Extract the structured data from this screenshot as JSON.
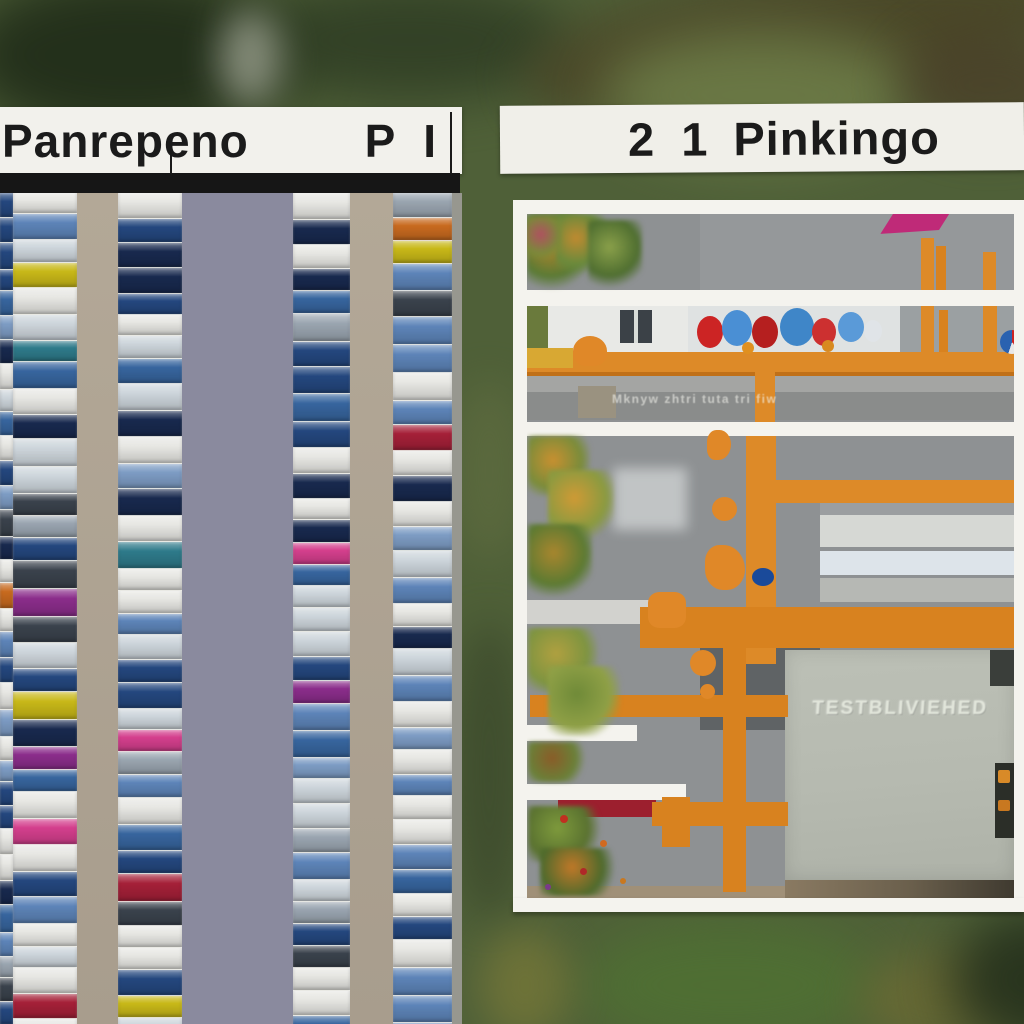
{
  "header": {
    "left_label": {
      "text": "Panrepeno",
      "code": "P I"
    },
    "right_label": {
      "number": "2 1",
      "text": "Pinkingo"
    }
  },
  "right_panel": {
    "building_text": "TESTBLIVIEHED",
    "road_text": "Mknyw zhtri tuta tri fiw",
    "frame_color": "#f4f3ee",
    "content_bg": "#8e9193",
    "rects": [
      {
        "n": "site-pavement",
        "x": 527,
        "y": 214,
        "w": 487,
        "h": 684,
        "c": "#8e9193"
      },
      {
        "n": "row1-pavement-shade",
        "x": 700,
        "y": 214,
        "w": 314,
        "h": 76,
        "c": "#95989a"
      },
      {
        "n": "row2-green-patch",
        "x": 527,
        "y": 306,
        "w": 22,
        "h": 46,
        "c": "#6a7a3c"
      },
      {
        "n": "row2-building-wall",
        "x": 548,
        "y": 306,
        "w": 142,
        "h": 46,
        "c": "#e8e9e6"
      },
      {
        "n": "row2-window",
        "x": 620,
        "y": 310,
        "w": 32,
        "h": 33,
        "c": "#3b4147"
      },
      {
        "n": "row2-window-slat",
        "x": 634,
        "y": 310,
        "w": 4,
        "h": 33,
        "c": "#d8dcd8"
      },
      {
        "n": "row2-white-backdrop",
        "x": 688,
        "y": 306,
        "w": 212,
        "h": 47,
        "c": "#dfe2e2"
      },
      {
        "n": "row2-gray-backdrop",
        "x": 900,
        "y": 306,
        "w": 114,
        "h": 47,
        "c": "#9ba0a2"
      },
      {
        "n": "row2-dot-markings",
        "x": 902,
        "y": 392,
        "w": 110,
        "h": 6,
        "c": "transparent",
        "cls": "dotrow"
      },
      {
        "n": "row2-upper-gray-beam",
        "x": 527,
        "y": 374,
        "w": 487,
        "h": 18,
        "c": "#a4a5a3"
      },
      {
        "n": "row2-lower-gray-beam",
        "x": 527,
        "y": 392,
        "w": 487,
        "h": 28,
        "c": "#8a8c8b"
      },
      {
        "n": "row2-yellow-speckle-patch",
        "x": 578,
        "y": 386,
        "w": 38,
        "h": 32,
        "c": "#9a9280",
        "cls": "speck"
      },
      {
        "n": "row3-sheen",
        "x": 613,
        "y": 468,
        "w": 74,
        "h": 62,
        "c": "rgba(235,238,238,.55)",
        "blur": 6
      },
      {
        "n": "row3-left-gray-band",
        "x": 527,
        "y": 600,
        "w": 128,
        "h": 24,
        "c": "#d2d2ce"
      },
      {
        "n": "window-building-gap",
        "x": 820,
        "y": 503,
        "w": 194,
        "h": 12,
        "c": "#9b9ea0"
      },
      {
        "n": "window-building-strip-top",
        "x": 820,
        "y": 515,
        "w": 194,
        "h": 32,
        "c": "#d6d8d4",
        "cls": "winA"
      },
      {
        "n": "window-building-strip-mid",
        "x": 820,
        "y": 551,
        "w": 194,
        "h": 24,
        "c": "#dde4ea",
        "cls": "winB"
      },
      {
        "n": "window-building-strip-low",
        "x": 820,
        "y": 578,
        "w": 194,
        "h": 24,
        "c": "#b6b8b4",
        "cls": "winC"
      },
      {
        "n": "dark-yard",
        "x": 700,
        "y": 640,
        "w": 120,
        "h": 90,
        "c": "#5f6365"
      },
      {
        "n": "big-gray-building",
        "x": 785,
        "y": 650,
        "w": 229,
        "h": 230,
        "c": "",
        "cls": "bigbuilding"
      },
      {
        "n": "building-dark-corner",
        "x": 990,
        "y": 650,
        "w": 24,
        "h": 36,
        "c": "#3a3e3a"
      },
      {
        "n": "building-dark-inset",
        "x": 995,
        "y": 763,
        "w": 19,
        "h": 75,
        "c": "#2b2e28"
      },
      {
        "n": "inset-orange-mark-1",
        "x": 998,
        "y": 770,
        "w": 12,
        "h": 13,
        "c": "#d88a28",
        "rad": "2px"
      },
      {
        "n": "inset-orange-mark-2",
        "x": 998,
        "y": 800,
        "w": 12,
        "h": 11,
        "c": "#c87820",
        "rad": "2px"
      },
      {
        "n": "building-base-strip",
        "x": 785,
        "y": 880,
        "w": 229,
        "h": 18,
        "c": "linear-gradient(90deg,#8a7a62,#6a5f4c 55%,#3f3a30)"
      },
      {
        "n": "left-bottom-tan-strip",
        "x": 527,
        "y": 886,
        "w": 258,
        "h": 12,
        "c": "#a09078"
      },
      {
        "n": "red-flower-strip",
        "x": 558,
        "y": 800,
        "w": 98,
        "h": 17,
        "c": "#9c1f2e"
      },
      {
        "n": "divider-band-1",
        "x": 513,
        "y": 290,
        "w": 501,
        "h": 16,
        "c": "#f4f3ee"
      },
      {
        "n": "divider-band-2",
        "x": 513,
        "y": 422,
        "w": 501,
        "h": 14,
        "c": "#f4f3ee"
      },
      {
        "n": "notch-band-1",
        "x": 513,
        "y": 725,
        "w": 124,
        "h": 16,
        "c": "#f4f3ee"
      },
      {
        "n": "notch-band-2",
        "x": 513,
        "y": 784,
        "w": 173,
        "h": 16,
        "c": "#f4f3ee"
      }
    ],
    "orange": [
      {
        "n": "crane-post",
        "x": 921,
        "y": 238,
        "w": 13,
        "h": 52,
        "c": "#dd8a28",
        "cls": "otexv"
      },
      {
        "n": "crane-post",
        "x": 936,
        "y": 246,
        "w": 10,
        "h": 44,
        "c": "#d8821f"
      },
      {
        "n": "crane-post",
        "x": 983,
        "y": 252,
        "w": 13,
        "h": 38,
        "c": "#dd8a28"
      },
      {
        "n": "crane-post",
        "x": 921,
        "y": 306,
        "w": 13,
        "h": 47,
        "c": "#dd8a28",
        "cls": "otexv"
      },
      {
        "n": "crane-post",
        "x": 939,
        "y": 310,
        "w": 9,
        "h": 43,
        "c": "#d8821f"
      },
      {
        "n": "crane-post",
        "x": 983,
        "y": 306,
        "w": 14,
        "h": 54,
        "c": "#dd8a28",
        "cls": "otexv"
      },
      {
        "n": "orange-rail",
        "x": 527,
        "y": 352,
        "w": 487,
        "h": 20,
        "c": "#dd8a28",
        "cls": "otexh"
      },
      {
        "n": "orange-rail-shadow-line",
        "x": 527,
        "y": 372,
        "w": 487,
        "h": 4,
        "c": "#c07018"
      },
      {
        "n": "rail-blob",
        "x": 573,
        "y": 336,
        "w": 34,
        "h": 30,
        "c": "#e08828",
        "rad": "50% 50% 40% 40%"
      },
      {
        "n": "yellow-machine",
        "x": 527,
        "y": 348,
        "w": 46,
        "h": 20,
        "c": "#d8a833"
      },
      {
        "n": "post-below-rail",
        "x": 755,
        "y": 372,
        "w": 20,
        "h": 50,
        "c": "#dd8a28",
        "cls": "otexv"
      },
      {
        "n": "gantry-vertical-beam",
        "x": 746,
        "y": 436,
        "w": 30,
        "h": 228,
        "c": "#dd8a28",
        "cls": "otexv"
      },
      {
        "n": "gantry-horizontal-beam",
        "x": 776,
        "y": 480,
        "w": 238,
        "h": 23,
        "c": "#dd8a28",
        "cls": "otexh"
      },
      {
        "n": "machinery-beam",
        "x": 640,
        "y": 607,
        "w": 374,
        "h": 41,
        "c": "#d8821f",
        "cls": "otexh"
      },
      {
        "n": "pipe-vertical",
        "x": 723,
        "y": 640,
        "w": 23,
        "h": 252,
        "c": "#d8821f",
        "cls": "otexv"
      },
      {
        "n": "pipe-horizontal",
        "x": 530,
        "y": 695,
        "w": 258,
        "h": 22,
        "c": "#d8821f",
        "cls": "otexh"
      },
      {
        "n": "pipe-horizontal",
        "x": 652,
        "y": 802,
        "w": 136,
        "h": 24,
        "c": "#d8821f",
        "cls": "otexh"
      },
      {
        "n": "pipe-elbow",
        "x": 662,
        "y": 797,
        "w": 28,
        "h": 50,
        "c": "#d8821f"
      },
      {
        "n": "digger",
        "x": 648,
        "y": 592,
        "w": 38,
        "h": 36,
        "c": "#e08828",
        "rad": "30%"
      },
      {
        "n": "cone-blob",
        "x": 707,
        "y": 430,
        "w": 24,
        "h": 30,
        "c": "#e08828",
        "rad": "45% 55% 60% 40%"
      },
      {
        "n": "cone-blob",
        "x": 712,
        "y": 497,
        "w": 25,
        "h": 24,
        "c": "#e08828",
        "rad": "50%"
      },
      {
        "n": "robot-arm",
        "x": 705,
        "y": 545,
        "w": 40,
        "h": 45,
        "c": "#e08828",
        "rad": "40% 60% 50% 50%"
      },
      {
        "n": "cone-blob",
        "x": 690,
        "y": 650,
        "w": 26,
        "h": 26,
        "c": "#e08828",
        "rad": "50%"
      },
      {
        "n": "cone-blob",
        "x": 545,
        "y": 650,
        "w": 30,
        "h": 28,
        "c": "#e08828",
        "rad": "50%"
      },
      {
        "n": "cone-blob",
        "x": 700,
        "y": 684,
        "w": 15,
        "h": 15,
        "c": "#e08828",
        "rad": "50%"
      }
    ],
    "trees": [
      {
        "n": "tree",
        "x": 527,
        "y": 214,
        "w": 60,
        "h": 76,
        "c1": "#5a7a34",
        "c2": "#b8862c"
      },
      {
        "n": "tree",
        "x": 556,
        "y": 214,
        "w": 50,
        "h": 60,
        "c1": "#6a8a3c",
        "c2": "#c08a30"
      },
      {
        "n": "tree",
        "x": 588,
        "y": 220,
        "w": 54,
        "h": 68,
        "c1": "#4f6e30",
        "c2": "#8aa04a"
      },
      {
        "n": "tree",
        "x": 527,
        "y": 216,
        "w": 34,
        "h": 46,
        "c1": "#7a8a3a",
        "c2": "#b05060"
      },
      {
        "n": "tree",
        "x": 528,
        "y": 436,
        "w": 62,
        "h": 60,
        "c1": "#7a8c3a",
        "c2": "#c89030"
      },
      {
        "n": "tree",
        "x": 548,
        "y": 470,
        "w": 66,
        "h": 70,
        "c1": "#8a9a40",
        "c2": "#cf9a35"
      },
      {
        "n": "tree",
        "x": 528,
        "y": 524,
        "w": 64,
        "h": 72,
        "c1": "#5c7a32",
        "c2": "#a8862e"
      },
      {
        "n": "tree",
        "x": 528,
        "y": 628,
        "w": 70,
        "h": 64,
        "c1": "#7e9440",
        "c2": "#b0a040"
      },
      {
        "n": "tree",
        "x": 548,
        "y": 666,
        "w": 72,
        "h": 70,
        "c1": "#8fa046",
        "c2": "#6f8a38"
      },
      {
        "n": "bush",
        "x": 528,
        "y": 742,
        "w": 60,
        "h": 40,
        "c1": "#6a8038",
        "c2": "#8a5c28"
      },
      {
        "n": "bush",
        "x": 528,
        "y": 806,
        "w": 74,
        "h": 56,
        "c1": "#5a7230",
        "c2": "#7e9a3c"
      },
      {
        "n": "bush",
        "x": 540,
        "y": 848,
        "w": 80,
        "h": 48,
        "c1": "#4e6a2c",
        "c2": "#c07828"
      }
    ],
    "circles": [
      {
        "n": "paint-blob-red",
        "x": 697,
        "y": 316,
        "w": 26,
        "h": 32,
        "c": "#cc2424"
      },
      {
        "n": "paint-blob-blue",
        "x": 722,
        "y": 310,
        "w": 30,
        "h": 36,
        "c": "#4a8fd4"
      },
      {
        "n": "paint-blob-red",
        "x": 752,
        "y": 316,
        "w": 26,
        "h": 32,
        "c": "#b51f1f"
      },
      {
        "n": "paint-blob-blue",
        "x": 780,
        "y": 308,
        "w": 34,
        "h": 38,
        "c": "#3f86c8"
      },
      {
        "n": "paint-blob-red",
        "x": 812,
        "y": 318,
        "w": 24,
        "h": 28,
        "c": "#cc3030"
      },
      {
        "n": "paint-blob-blue",
        "x": 838,
        "y": 312,
        "w": 26,
        "h": 30,
        "c": "#5a9ad8"
      },
      {
        "n": "paint-blob-white",
        "x": 864,
        "y": 320,
        "w": 18,
        "h": 22,
        "c": "#e0e4e8"
      },
      {
        "n": "paint-dot-orange",
        "x": 742,
        "y": 342,
        "w": 12,
        "h": 12,
        "c": "#e09020"
      },
      {
        "n": "paint-dot-orange",
        "x": 822,
        "y": 340,
        "w": 12,
        "h": 12,
        "c": "#d88a20"
      },
      {
        "n": "beach-ball",
        "x": 1000,
        "y": 330,
        "w": 24,
        "h": 24,
        "c": "",
        "grad": "conic-gradient(#cc2222 0 40%,#e8e8e8 40% 55%,#2a62b0 55% 100%)"
      },
      {
        "n": "blue-barrel",
        "x": 752,
        "y": 568,
        "w": 22,
        "h": 18,
        "c": "#1a4a9a"
      },
      {
        "n": "flower-dot",
        "x": 560,
        "y": 815,
        "w": 8,
        "h": 8,
        "c": "#c03020"
      },
      {
        "n": "flower-dot",
        "x": 600,
        "y": 840,
        "w": 7,
        "h": 7,
        "c": "#d06a20"
      },
      {
        "n": "flower-dot",
        "x": 580,
        "y": 868,
        "w": 7,
        "h": 7,
        "c": "#b02828"
      },
      {
        "n": "flower-dot",
        "x": 620,
        "y": 878,
        "w": 6,
        "h": 6,
        "c": "#c87820"
      },
      {
        "n": "flower-dot",
        "x": 545,
        "y": 884,
        "w": 6,
        "h": 6,
        "c": "#7a3a8a"
      }
    ],
    "umbrella": {
      "n": "pink-umbrella",
      "x": 888,
      "y": 212,
      "w": 56,
      "h": 20,
      "c": "#bf2a78"
    }
  },
  "left_panel": {
    "top": 193,
    "bottom": 1024,
    "base": "#8a8a9e",
    "aisle_color": "#b3a897",
    "aisles": [
      {
        "x": 77,
        "w": 41
      },
      {
        "x": 350,
        "w": 43
      }
    ],
    "edge_strip": {
      "x": 452,
      "w": 10,
      "c": "#97978f"
    },
    "column_bg": "#c6c6c2",
    "columns": [
      {
        "x": 0,
        "w": 13,
        "seed": 11
      },
      {
        "x": 13,
        "w": 64,
        "seed": 23
      },
      {
        "x": 118,
        "w": 64,
        "seed": 47
      },
      {
        "x": 293,
        "w": 57,
        "seed": 71
      },
      {
        "x": 393,
        "w": 59,
        "seed": 95
      }
    ],
    "car_min_h": 20,
    "car_max_h": 28,
    "palette": [
      {
        "c": "#e7e7e3",
        "w": 9
      },
      {
        "c": "#cdd5db",
        "w": 4
      },
      {
        "c": "#5d84b8",
        "w": 4
      },
      {
        "c": "#37659e",
        "w": 5
      },
      {
        "c": "#24477e",
        "w": 5
      },
      {
        "c": "#18294e",
        "w": 4
      },
      {
        "c": "#9aa5b0",
        "w": 3
      },
      {
        "c": "#3a424c",
        "w": 3
      },
      {
        "c": "#7d9cc4",
        "w": 3
      },
      {
        "c": "#d43f8d",
        "w": 1
      },
      {
        "c": "#8b2d8b",
        "w": 1
      },
      {
        "c": "#a52038",
        "w": 1
      },
      {
        "c": "#c8b818",
        "w": 0.6
      },
      {
        "c": "#c86a1f",
        "w": 0.7
      },
      {
        "c": "#2e7a8a",
        "w": 1
      }
    ]
  },
  "background": {
    "base": "#4f6038",
    "blobs": [
      {
        "n": "dark-treeline",
        "x": -40,
        "y": -30,
        "w": 340,
        "h": 170,
        "c": "#1f2b18",
        "blur": 28,
        "o": 0.9
      },
      {
        "n": "dark-treeline",
        "x": 250,
        "y": -20,
        "w": 320,
        "h": 120,
        "c": "#2c3a22",
        "blur": 26,
        "o": 0.8
      },
      {
        "n": "light-path",
        "x": 218,
        "y": 10,
        "w": 64,
        "h": 96,
        "c": "#9aa08e",
        "blur": 18,
        "o": 0.8
      },
      {
        "n": "brown-streak",
        "x": 520,
        "y": -30,
        "w": 560,
        "h": 140,
        "c": "#4a4426",
        "blur": 24,
        "o": 0.85,
        "rot": "rotate(-9deg)"
      },
      {
        "n": "light-meadow",
        "x": 600,
        "y": 30,
        "w": 320,
        "h": 130,
        "c": "#6f7f49",
        "blur": 28,
        "o": 0.85
      },
      {
        "n": "brown-blob",
        "x": 900,
        "y": 30,
        "w": 180,
        "h": 110,
        "c": "#4a3f28",
        "blur": 24,
        "o": 0.8
      },
      {
        "n": "divider-light",
        "x": 452,
        "y": 380,
        "w": 74,
        "h": 180,
        "c": "#5d6b3f",
        "blur": 20,
        "o": 0.8
      },
      {
        "n": "divider-dark",
        "x": 452,
        "y": 620,
        "w": 74,
        "h": 300,
        "c": "#3c4a2c",
        "blur": 20,
        "o": 0.8
      },
      {
        "n": "below-frame-green",
        "x": 580,
        "y": 920,
        "w": 300,
        "h": 130,
        "c": "#4f7033",
        "blur": 26,
        "o": 0.9
      },
      {
        "n": "bottom-olive",
        "x": 860,
        "y": 950,
        "w": 170,
        "h": 100,
        "c": "#6a6a34",
        "blur": 22,
        "o": 0.85
      },
      {
        "n": "bottom-dark",
        "x": 950,
        "y": 910,
        "w": 180,
        "h": 140,
        "c": "#24301c",
        "blur": 26,
        "o": 0.9
      },
      {
        "n": "bottom-left-olive",
        "x": 480,
        "y": 930,
        "w": 90,
        "h": 110,
        "c": "#7a7a38",
        "blur": 20,
        "o": 0.7
      }
    ]
  }
}
